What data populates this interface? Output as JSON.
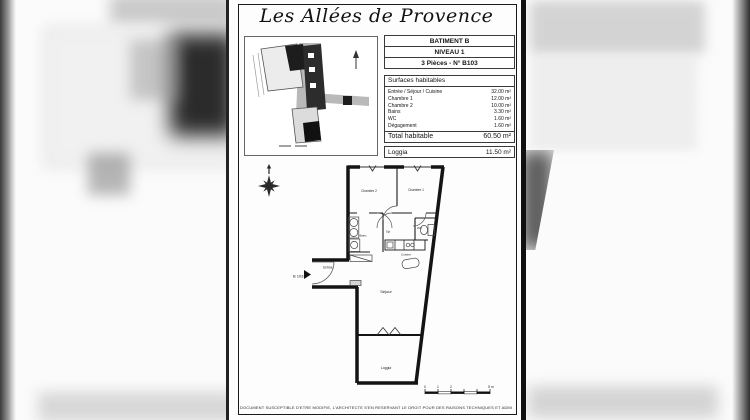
{
  "colors": {
    "ink": "#141414",
    "page_bg": "#fdfdfd",
    "canvas_bg": "#efefef"
  },
  "document": {
    "title": "Les Allées de Provence",
    "building_info": {
      "rows": [
        "BATIMENT B",
        "NIVEAU 1",
        "3 Pièces - N° B103"
      ]
    },
    "surfaces": {
      "header": "Surfaces habitables",
      "rows": [
        {
          "label": "Entrée / Séjour / Cuisine",
          "value": "32.00 m²"
        },
        {
          "label": "Chambre 1",
          "value": "12.00 m²"
        },
        {
          "label": "Chambre 2",
          "value": "10.00 m²"
        },
        {
          "label": "Bains",
          "value": "3.30 m²"
        },
        {
          "label": "WC",
          "value": "1.60 m²"
        },
        {
          "label": "Dégagement",
          "value": "1.60 m²"
        }
      ],
      "total": {
        "label": "Total habitable",
        "value": "60.50 m²"
      },
      "loggia": {
        "label": "Loggia",
        "value": "11.50 m²"
      }
    },
    "floor_plan": {
      "unit": "B 103",
      "labels": {
        "chambre2": "Chambre 2",
        "chambre1": "Chambre 1",
        "bains": "Bains",
        "wc": "WC",
        "dgt": "Dgt",
        "cuisine": "Cuisine",
        "sejour": "Séjour",
        "entree": "Entrée",
        "loggia": "Loggia"
      },
      "scale": {
        "t0": "0",
        "t1": "1",
        "t2": "2",
        "t5": "5 m"
      }
    },
    "disclaimer": "DOCUMENT SUSCEPTIBLE D'ETRE MODIFIE, L'ARCHITECTE S'EN RESERVANT LE DROIT POUR DES RAISONS TECHNIQUES ET ADMINISTRATIVES."
  }
}
